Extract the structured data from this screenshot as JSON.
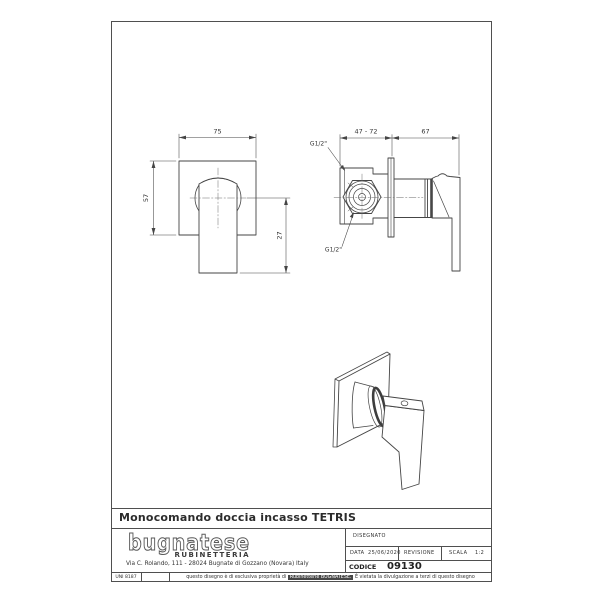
{
  "drawing": {
    "front_view": {
      "dim_width": "75",
      "dim_height": "57",
      "dim_handle_drop": "27"
    },
    "side_view": {
      "dim_wall_range": "47 - 72",
      "dim_projection": "67",
      "thread_top": "G1/2\"",
      "thread_bottom": "G1/2\""
    }
  },
  "title_block": {
    "product_title": "Monocomando doccia incasso TETRIS",
    "brand": {
      "logo_text": "bugnatese",
      "logo_subtitle": "RUBINETTERIA",
      "address": "Via C. Rolando, 111 - 28024 Bugnate di Gozzano (Novara) Italy"
    },
    "fields": {
      "disegnato_label": "DISEGNATO",
      "data_label": "DATA",
      "data_value": "25/06/2020",
      "revisione_label": "REVISIONE",
      "scala_label": "SCALA",
      "scala_value": "1:2",
      "codice_label": "CODICE",
      "codice_value": "09130"
    }
  },
  "footer": {
    "norm": "UNI 8187",
    "note_prefix": "questo disegno è di esclusiva proprietà di",
    "note_highlight": "Rubinetterie BUGNATESE.",
    "note_suffix": "È vietata la divulgazione a terzi di questo disegno"
  }
}
